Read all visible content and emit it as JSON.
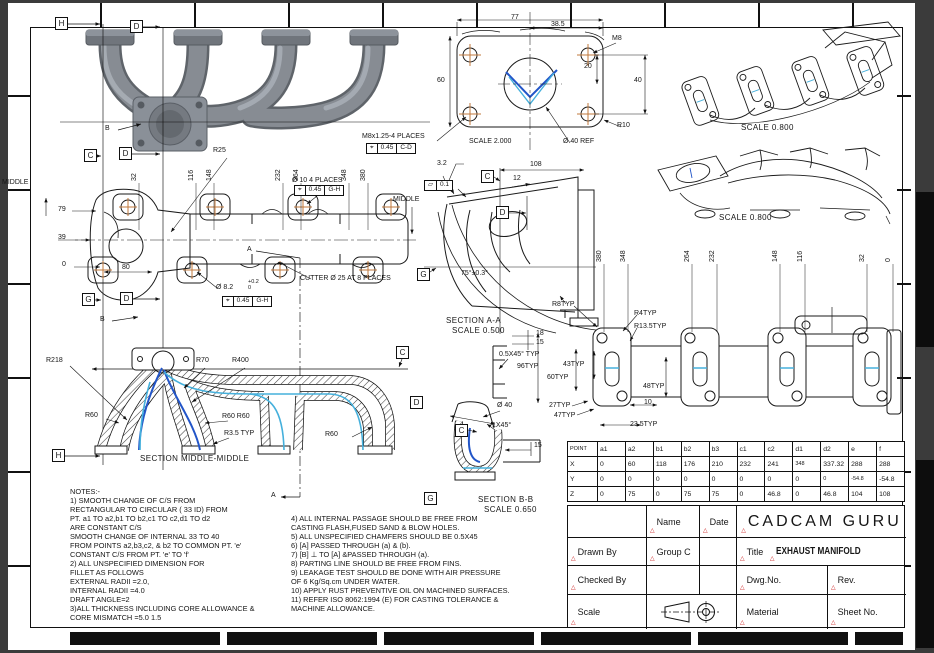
{
  "colors": {
    "paper": "#ffffff",
    "ink": "#1a1a1a",
    "background": "#3b3b3b",
    "centermark": "#c0783c",
    "spline_dark": "#2255c8",
    "spline_light": "#45b0dc",
    "marker_red": "#cc2222",
    "render_gray": "#878c93"
  },
  "icons": {
    "marker": "△",
    "position": "⌖",
    "flatness": "▱"
  },
  "ff": {
    "d77": "77",
    "d38_5": "38.5",
    "m8": "M8",
    "d20": "20",
    "d40": "40",
    "d60": "60",
    "r10": "R10",
    "d40ref": "Ø 40 REF",
    "scale": "SCALE  2.000",
    "thread": "M8x1.25-4 PLACES",
    "fcf_tol": "0.45",
    "fcf_dat": "C-D"
  },
  "fv": {
    "stations": [
      "32",
      "116",
      "148",
      "232",
      "264",
      "348",
      "380"
    ],
    "r25": "R25",
    "mid_l": "MIDDLE",
    "mid_r": "MIDDLE",
    "d79": "79",
    "d39": "39",
    "d0": "0",
    "d80": "80",
    "hole_note": "Ø 10 4 PLACES",
    "fcf1_tol": "0.45",
    "fcf1_dat": "G-H",
    "hole2": "Ø 8.2",
    "tol": "+0.2\n0",
    "fcf2_tol": "0.45",
    "fcf2_dat": "G-H",
    "cutter": "CUTTER Ø 25 AT 8 PLACES",
    "a": "A",
    "b": "B"
  },
  "aa": {
    "fin": "3.2",
    "flat_tol": "0.1",
    "d108": "108",
    "d12": "12",
    "ang": "75°±0.3°",
    "r8": "R8TYP",
    "title": "SECTION  A-A",
    "scale": "SCALE  0.500"
  },
  "rv": {
    "stations": [
      "380",
      "348",
      "264",
      "232",
      "148",
      "116",
      "32",
      "0"
    ],
    "r4": "R4TYP",
    "r135": "R13.5TYP",
    "d43": "43TYP",
    "d96": "96TYP",
    "d60": "60TYP",
    "d48": "48TYP",
    "d27": "27TYP",
    "d47": "47TYP",
    "d10": "10",
    "d235": "23.5TYP",
    "cham": "0.5X45° TYP",
    "d18": "18",
    "d15": "15"
  },
  "mm": {
    "r218": "R218",
    "r70": "R70",
    "r400": "R400",
    "r60a": "R60",
    "r60b": "R60 R60",
    "r35": "R3.5 TYP",
    "r60c": "R60",
    "title": "SECTION  MIDDLE-MIDDLE"
  },
  "bb": {
    "d40": "Ø 40",
    "cham": "1X45°",
    "d15": "15",
    "title": "SECTION  B-B",
    "scale": "SCALE  0.650"
  },
  "iso": {
    "scale1": "SCALE  0.800",
    "scale2": "SCALE  0.800"
  },
  "datums": {
    "h": "H",
    "d": "D",
    "c": "C",
    "g": "G",
    "b": "B"
  },
  "notes": {
    "left": "NOTES:-\n1) SMOOTH CHANGE OF C/S FROM\nRECTANGULAR TO CIRCULAR ( 33 ID) FROM\nPT. a1 TO a2,b1 TO b2,c1 TO c2,d1 TO d2\nARE CONSTANT C/S\nSMOOTH CHANGE OF INTERNAL 33 TO 40\nFROM POINTS a2,b3,c2, & b2 TO COMMON PT. 'e'\nCONSTANT C/S FROM PT. 'e' TO 'f'\n2) ALL UNSPECIFIED DIMENSION FOR\nFILLET AS FOLLOWS\nEXTERNAL RADII =2.0,\nINTERNAL RADII =4.0\nDRAFT ANGLE=2\n3)ALL THICKNESS INCLUDING CORE ALLOWANCE &\nCORE MISMATCH =5.0 1.5",
    "right": "4) ALL INTERNAL PASSAGE SHOULD BE FREE FROM\nCASTING FLASH,FUSED SAND & BLOW HOLES.\n5) ALL UNSPECIFIED CHAMFERS SHOULD BE 0.5X45\n6) [A] PASSED THROUGH (a) & (b).\n7) [B] ⊥ TO [A] &PASSED THROUGH (a).\n8) PARTING LINE SHOULD BE FREE FROM FINS.\n9) LEAKAGE TEST SHOULD BE DONE WITH AIR PRESSURE\nOF 6 Kg/Sq.cm UNDER WATER.\n10) APPLY RUST PREVENTIVE OIL ON MACHINED SURFACES.\n11) REFER ISO 8062:1994 (E) FOR CASTING TOLERANCE &\nMACHINE ALLOWANCE."
  },
  "pt": {
    "headers": [
      "POINT",
      "a1",
      "a2",
      "b1",
      "b2",
      "b3",
      "c1",
      "c2",
      "d1",
      "d2",
      "e",
      "f"
    ],
    "rows": [
      [
        "X",
        "0",
        "60",
        "118",
        "176",
        "210",
        "232",
        "241",
        "348",
        "337.32",
        "288",
        "288"
      ],
      [
        "Y",
        "0",
        "0",
        "0",
        "0",
        "0",
        "0",
        "0",
        "0",
        "0",
        "-54.8",
        "-54.8"
      ],
      [
        "Z",
        "0",
        "75",
        "0",
        "75",
        "75",
        "0",
        "46.8",
        "0",
        "46.8",
        "104",
        "108"
      ]
    ]
  },
  "tb": {
    "company": "CADCAM  GURU",
    "name": "Name",
    "date": "Date",
    "drawn": "Drawn  By",
    "group": "Group C",
    "title_label": "Title",
    "title": "EXHAUST MANIFOLD",
    "checked": "Checked  By",
    "dwg": "Dwg.No.",
    "rev": "Rev.",
    "scale": "Scale",
    "material": "Material",
    "sheet": "Sheet  No."
  }
}
